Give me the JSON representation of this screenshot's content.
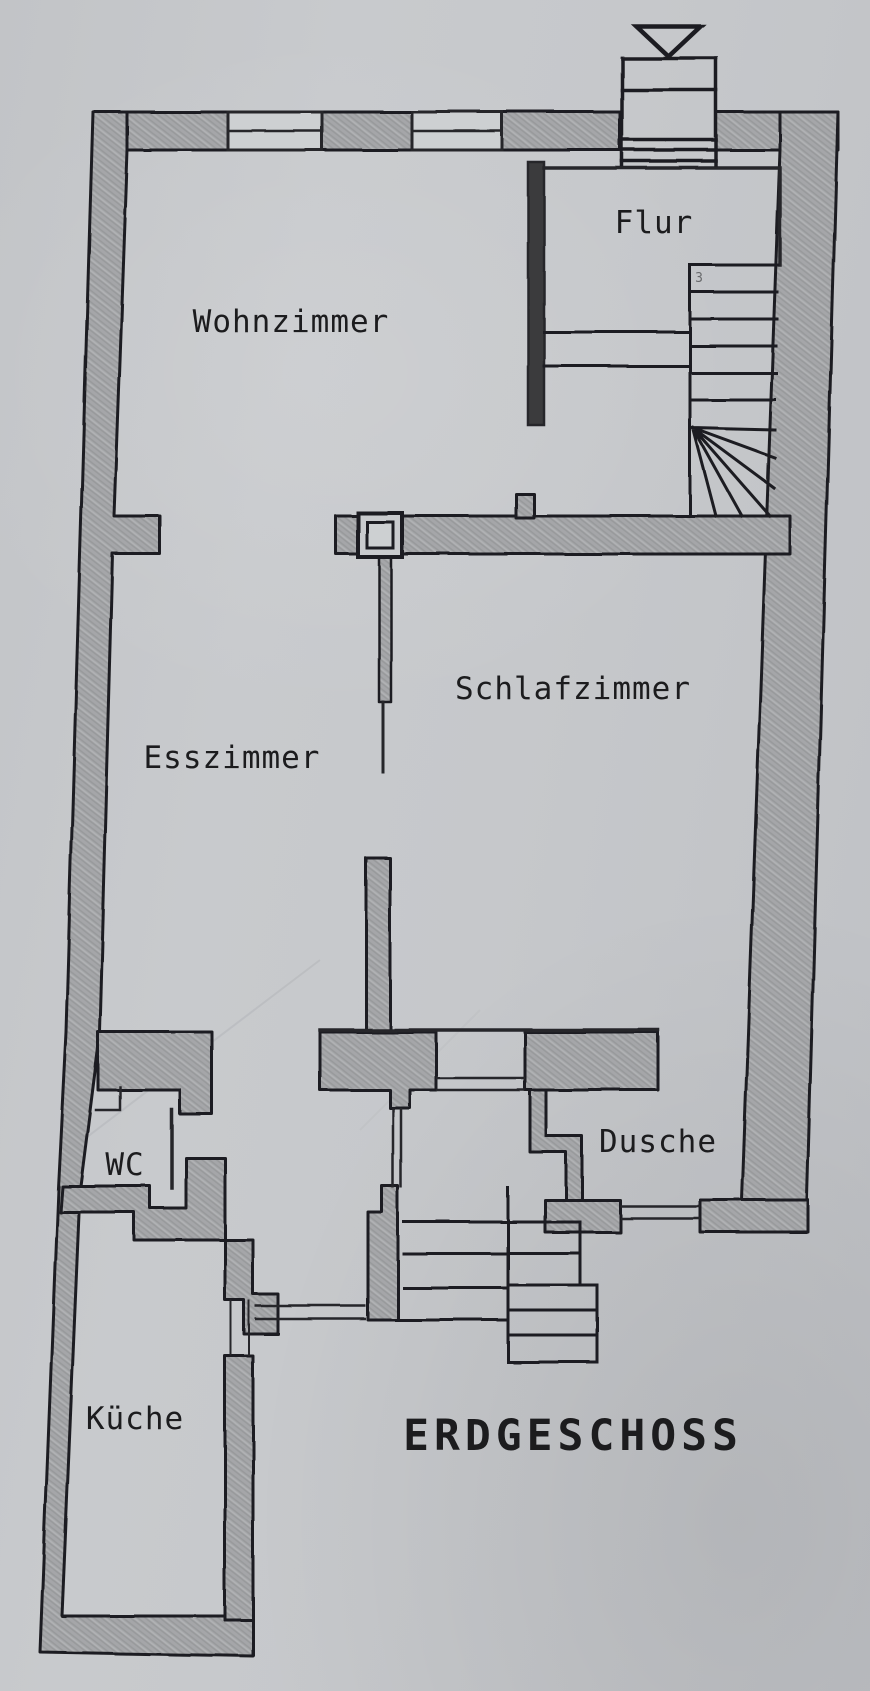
{
  "title": {
    "label": "ERDGESCHOSS"
  },
  "rooms": {
    "flur": "Flur",
    "wohnzimmer": "Wohnzimmer",
    "schlafzimmer": "Schlafzimmer",
    "esszimmer": "Esszimmer",
    "wc": "WC",
    "dusche": "Dusche",
    "kueche": "Küche"
  },
  "annotations": {
    "stair_mark": "3"
  },
  "colors": {
    "paper": "#c6c8cb",
    "pencil_wall": "#a5a6a9",
    "ink": "#1f1f20"
  }
}
